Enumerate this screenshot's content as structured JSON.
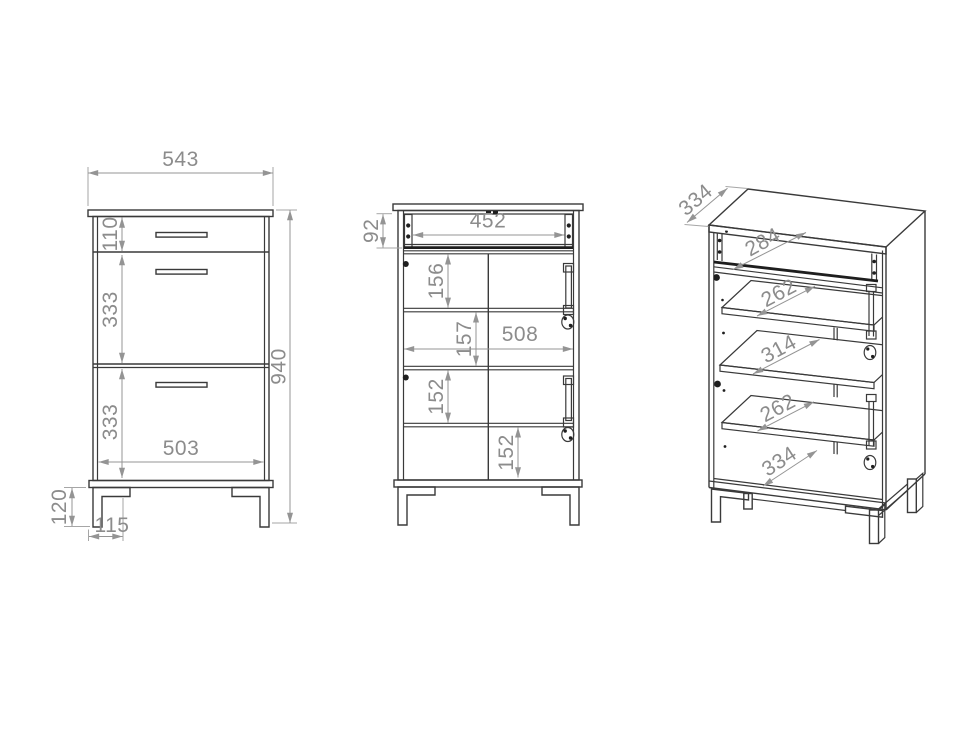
{
  "drawing": {
    "type": "furniture-technical-drawing",
    "subject": "cabinet with drawer, doors and shelves - three orthographic/perspective views",
    "colors": {
      "background": "#ffffff",
      "outline": "#3a3a3a",
      "dimension": "#8c8c8c"
    },
    "front_view": {
      "dims": {
        "overall_width": "543",
        "top_drawer_height": "110",
        "middle_section_height": "333",
        "bottom_section_height": "333",
        "interior_width": "503",
        "overall_height": "940",
        "leg_height": "120",
        "leg_width": "115"
      }
    },
    "open_view": {
      "dims": {
        "drawer_box_height": "92",
        "drawer_interior_width": "452",
        "compartment_1_height": "156",
        "compartment_2_height": "157",
        "interior_width": "508",
        "compartment_3_height": "152",
        "compartment_4_height": "152"
      }
    },
    "perspective_view": {
      "dims": {
        "overall_depth": "334",
        "drawer_shelf_depth": "284",
        "upper_shelf_depth": "262",
        "middle_shelf_depth": "314",
        "lower_shelf_depth": "262",
        "bottom_shelf_depth": "334"
      }
    }
  }
}
